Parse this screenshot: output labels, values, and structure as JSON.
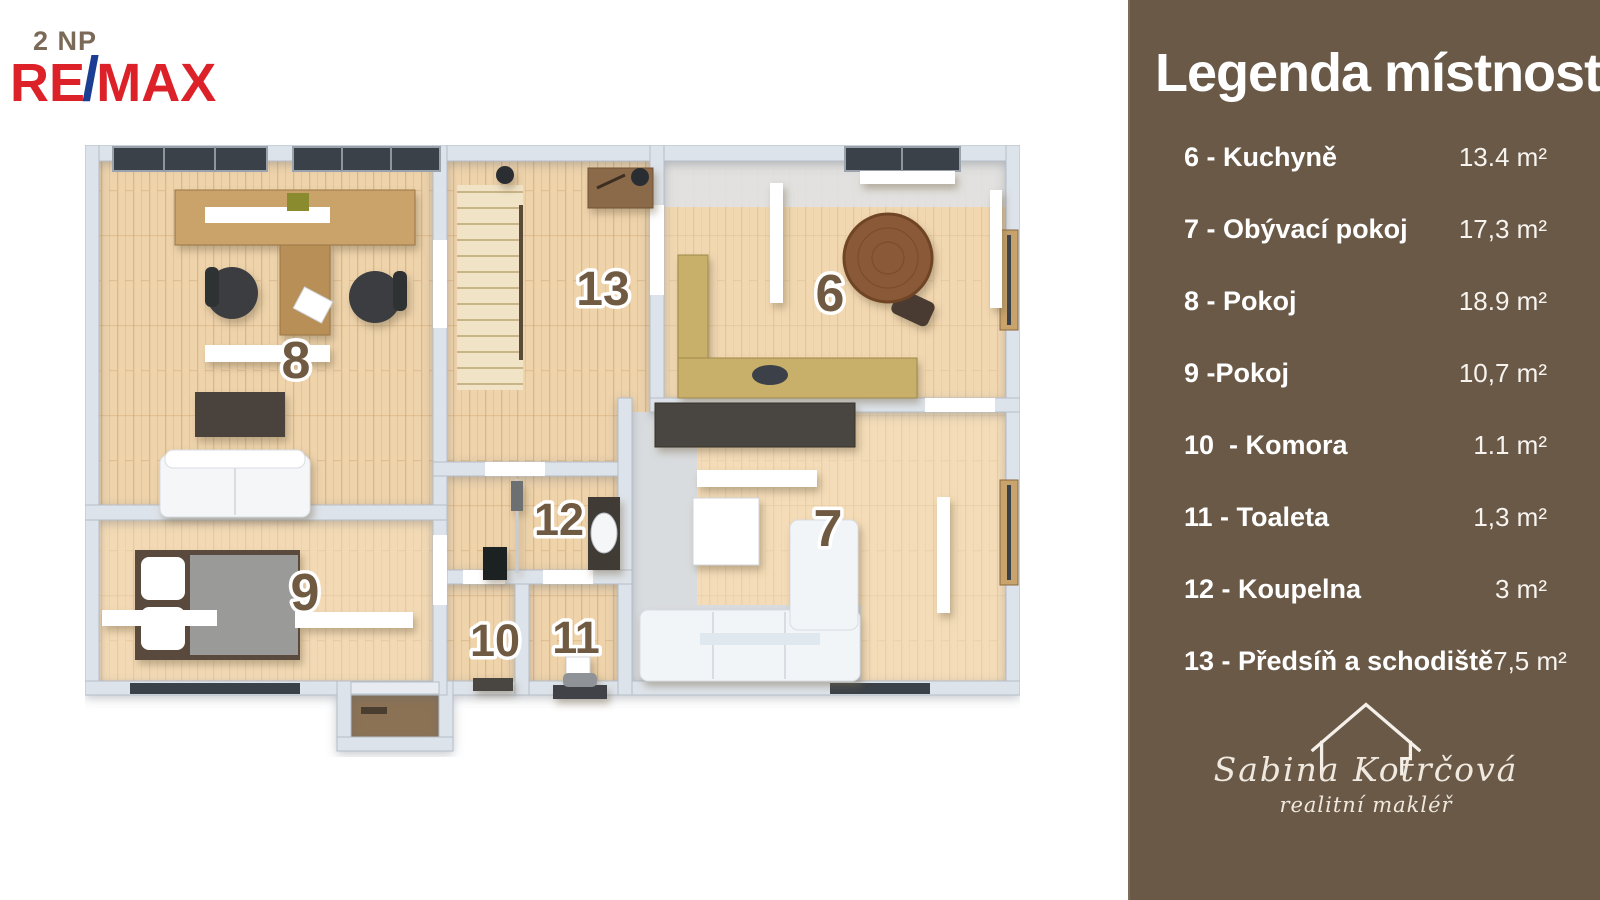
{
  "page": {
    "floor_label": "2 NP"
  },
  "brand": {
    "re": "RE",
    "slash": "/",
    "max": "MAX",
    "red": "#dc2128",
    "blue": "#1c3e92"
  },
  "legend": {
    "title": "Legenda místností",
    "rooms": [
      {
        "number": "6",
        "label": "6 - Kuchyně",
        "area": "13.4 m²"
      },
      {
        "number": "7",
        "label": "7 - Obývací pokoj",
        "area": "17,3 m²"
      },
      {
        "number": "8",
        "label": "8 - Pokoj",
        "area": "18.9 m²"
      },
      {
        "number": "9",
        "label": "9 -Pokoj",
        "area": "10,7 m²"
      },
      {
        "number": "10",
        "label": "10  - Komora",
        "area": "1.1 m²"
      },
      {
        "number": "11",
        "label": "11 - Toaleta",
        "area": "1,3 m²"
      },
      {
        "number": "12",
        "label": "12 - Koupelna",
        "area": "3 m²"
      },
      {
        "number": "13",
        "label": "13 - Předsíň a schodiště",
        "area": "7,5 m²"
      }
    ]
  },
  "agent": {
    "name": "Sabina Kotrčová",
    "role": "realitní makléř"
  },
  "colors": {
    "sidebar": "#6a5947",
    "room_number": "#705a42",
    "wood_floor": "#eed3ab",
    "wall": "#dde3ea"
  }
}
